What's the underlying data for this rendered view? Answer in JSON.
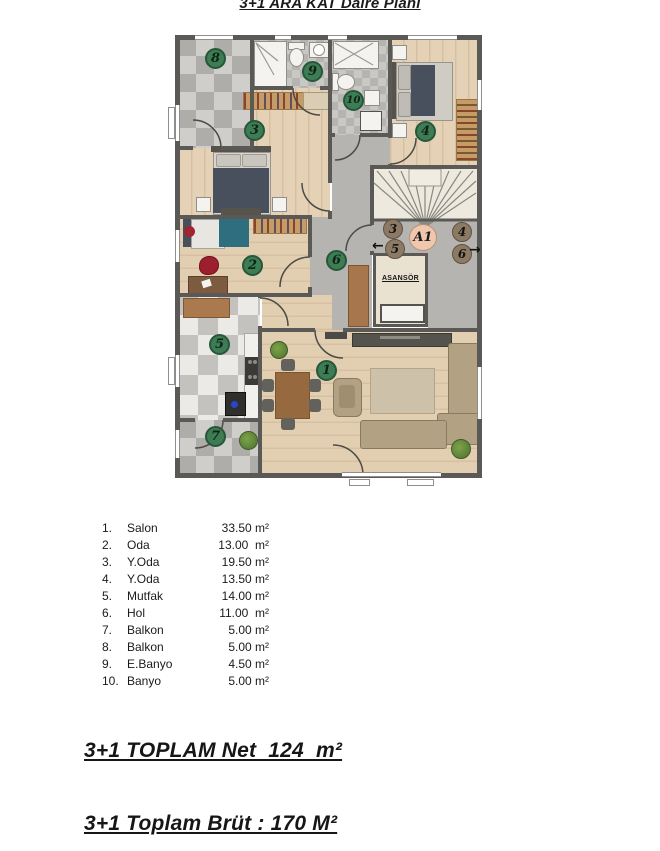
{
  "title": "3+1 ARA KAT Daire Planı",
  "plan": {
    "markers": [
      {
        "label": "1"
      },
      {
        "label": "2"
      },
      {
        "label": "3"
      },
      {
        "label": "4"
      },
      {
        "label": "5"
      },
      {
        "label": "6"
      },
      {
        "label": "7"
      },
      {
        "label": "8"
      },
      {
        "label": "9"
      },
      {
        "label": "10"
      }
    ],
    "landing": {
      "block_label": "A1",
      "left_top": "3",
      "left_bottom": "5",
      "right_top": "4",
      "right_bottom": "6",
      "arrow_left": "←",
      "arrow_right": "→"
    },
    "elevator_label": "ASANSÖR"
  },
  "room_list": {
    "items": [
      {
        "no": "1.",
        "name": "Salon",
        "area": "33.50 m²"
      },
      {
        "no": "2.",
        "name": "Oda",
        "area": "13.00  m²"
      },
      {
        "no": "3.",
        "name": "Y.Oda",
        "area": "19.50 m²"
      },
      {
        "no": "4.",
        "name": "Y.Oda",
        "area": "13.50 m²"
      },
      {
        "no": "5.",
        "name": "Mutfak",
        "area": "14.00 m²"
      },
      {
        "no": "6.",
        "name": "Hol",
        "area": "11.00  m²"
      },
      {
        "no": "7.",
        "name": "Balkon",
        "area": "5.00 m²"
      },
      {
        "no": "8.",
        "name": "Balkon",
        "area": "5.00 m²"
      },
      {
        "no": "9.",
        "name": "E.Banyo",
        "area": "4.50 m²"
      },
      {
        "no": "10.",
        "name": "Banyo",
        "area": "5.00 m²"
      }
    ]
  },
  "totals": {
    "net": "3+1 TOPLAM Net  124  m²",
    "brut": "3+1 Toplam Brüt : 170 M²"
  },
  "colors": {
    "marker_green": "#3e7c54",
    "unit_circle_brown": "#8d7a64",
    "block_circle_pink": "#eec7ae",
    "wall": "#5b5955",
    "wood_floor": "#e5d2b6",
    "teal_bed": "#2f6e7e",
    "navy_blanket": "#47505c"
  }
}
